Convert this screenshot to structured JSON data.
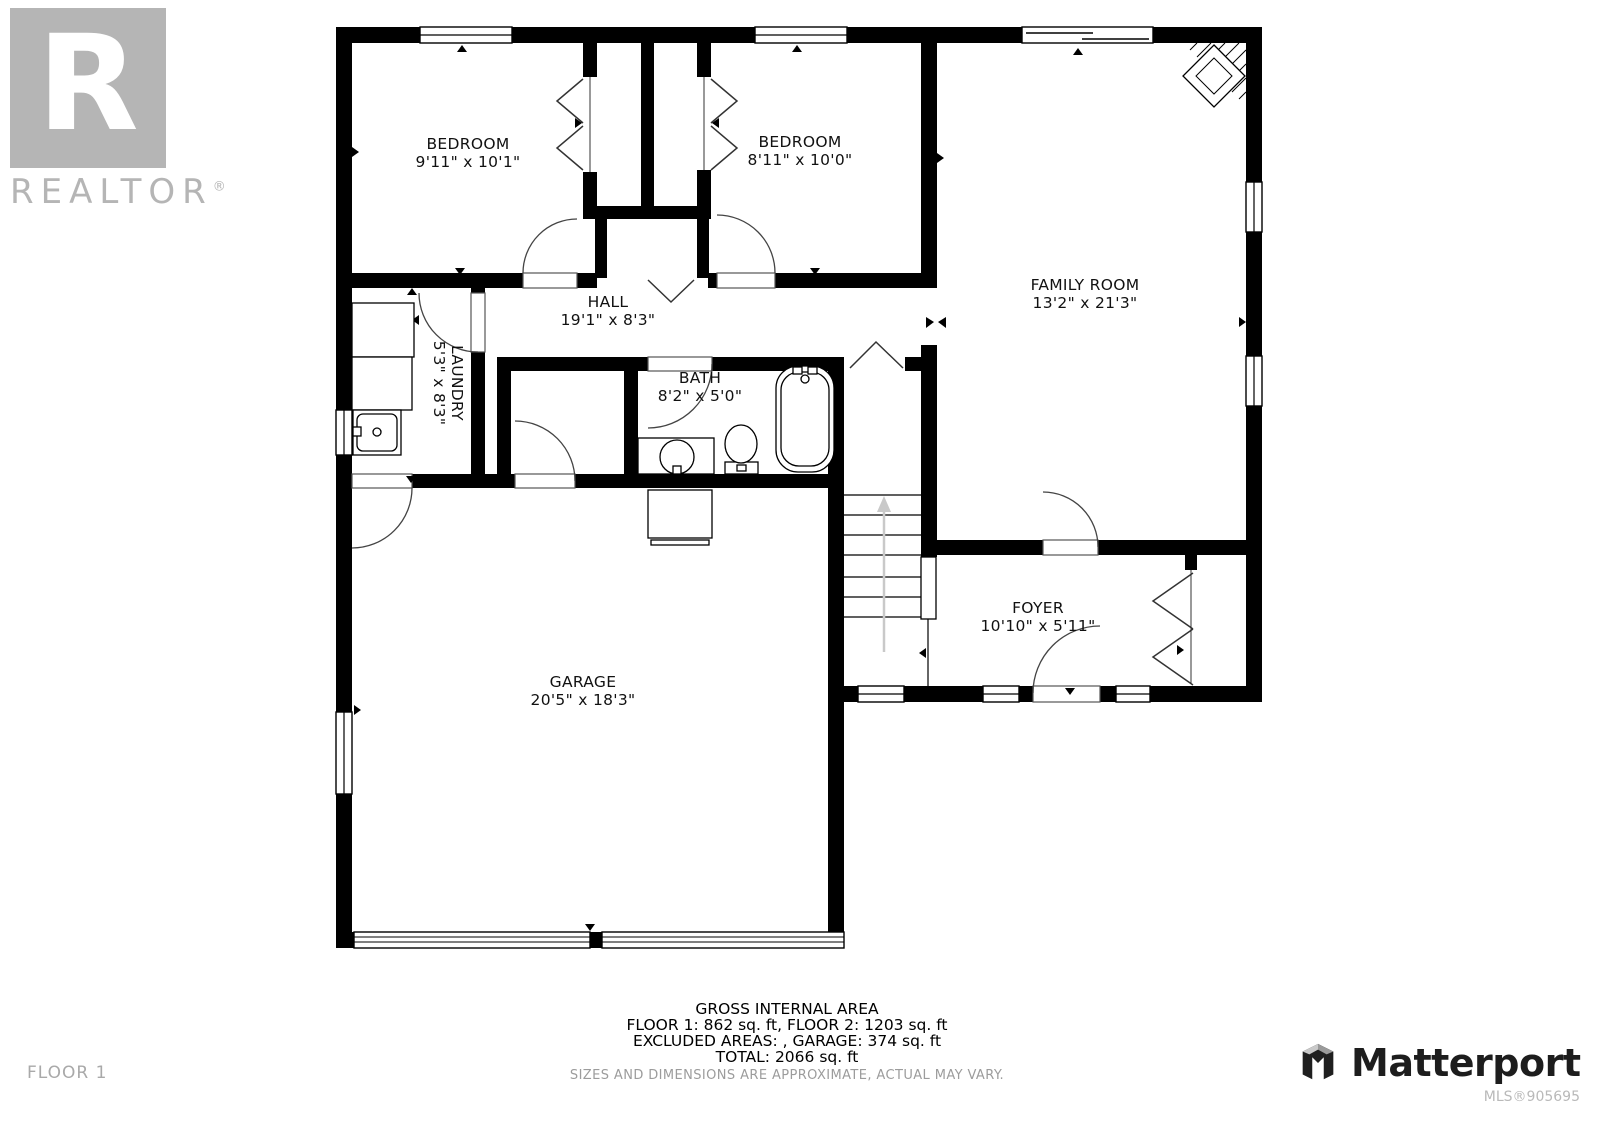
{
  "branding": {
    "realtor_letter": "R",
    "realtor_wordmark": "REALTOR",
    "registered_mark": "®",
    "matterport_name": "Matterport",
    "mls_number": "MLS®905695",
    "floor_label": "FLOOR 1"
  },
  "rooms": {
    "bedroom1": {
      "name": "BEDROOM",
      "dims": "9'11\" x 10'1\""
    },
    "bedroom2": {
      "name": "BEDROOM",
      "dims": "8'11\" x 10'0\""
    },
    "family": {
      "name": "FAMILY ROOM",
      "dims": "13'2\" x 21'3\""
    },
    "hall": {
      "name": "HALL",
      "dims": "19'1\" x 8'3\""
    },
    "laundry": {
      "name": "LAUNDRY",
      "dims": "5'3\" x 8'3\""
    },
    "bath": {
      "name": "BATH",
      "dims": "8'2\" x 5'0\""
    },
    "foyer": {
      "name": "FOYER",
      "dims": "10'10\" x 5'11\""
    },
    "garage": {
      "name": "GARAGE",
      "dims": "20'5\" x 18'3\""
    }
  },
  "footer": {
    "title": "GROSS INTERNAL AREA",
    "line1": "FLOOR 1: 862 sq. ft, FLOOR 2: 1203 sq. ft",
    "line2": "EXCLUDED AREAS: , GARAGE: 374 sq. ft",
    "line3": "TOTAL: 2066 sq. ft",
    "disclaimer": "SIZES AND DIMENSIONS ARE APPROXIMATE, ACTUAL MAY VARY."
  },
  "icons": [
    "fireplace-icon",
    "washer-icon",
    "dryer-icon",
    "utility-sink-icon",
    "vanity-sink-icon",
    "toilet-icon",
    "bathtub-icon",
    "furnace-icon",
    "stairs-up-arrow-icon",
    "matterport-icon",
    "realtor-icon"
  ],
  "colors": {
    "wall": "#000000",
    "label": "#111111",
    "stairs_arrow": "#c9c9c9",
    "logo_gray": "#b5b5b5",
    "brand_dark": "#1d1d1d",
    "muted_text": "#9c9c9c"
  }
}
